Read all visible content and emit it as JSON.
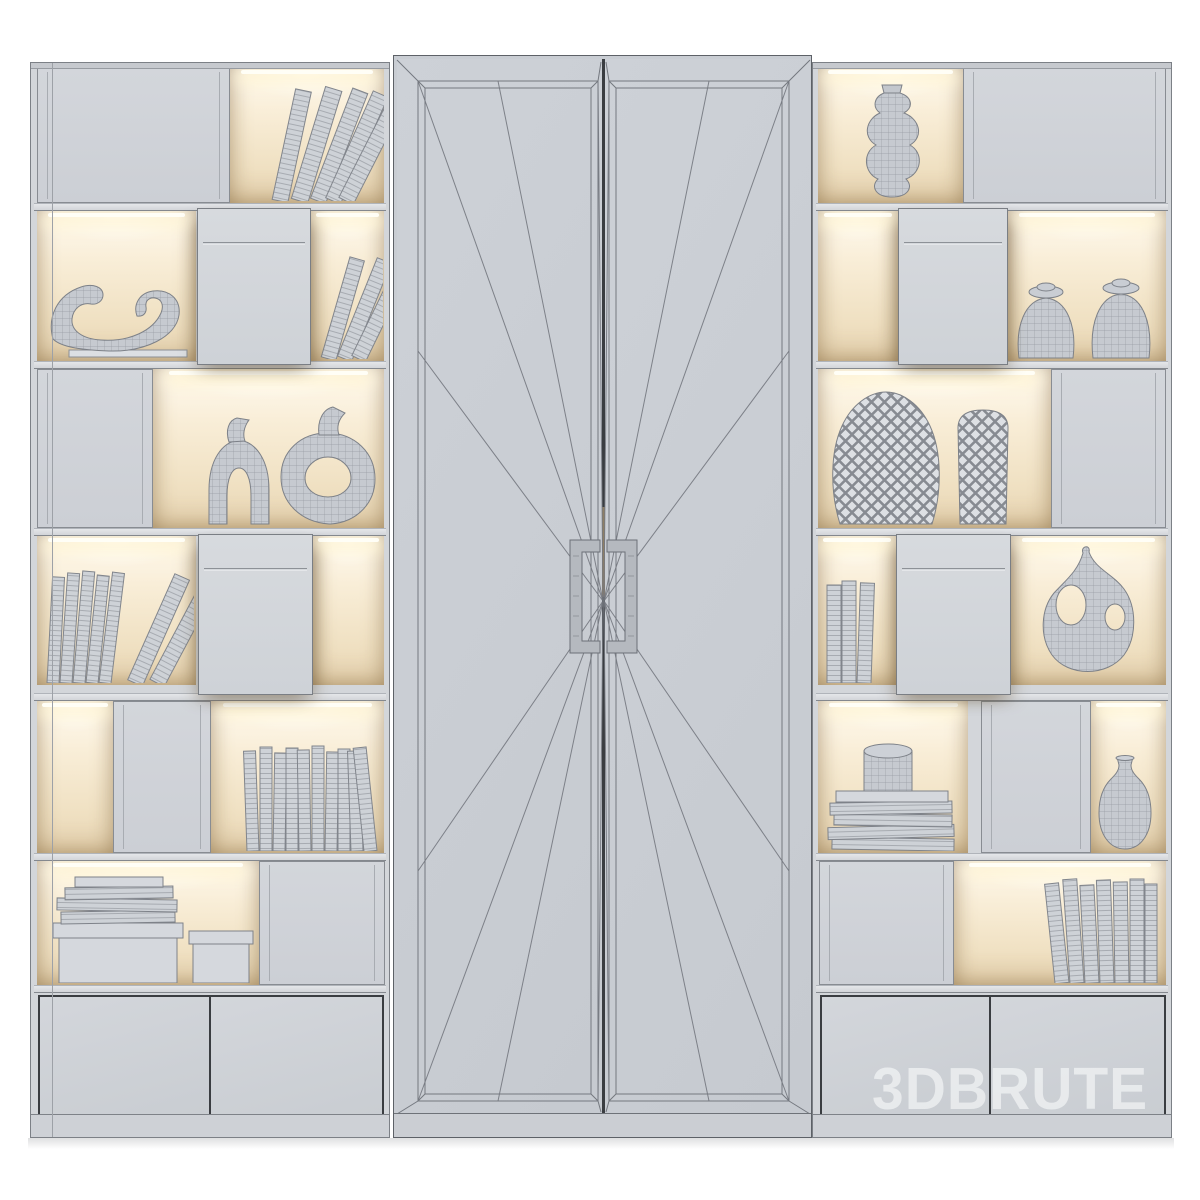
{
  "watermark": {
    "text": "3DBRUTE"
  },
  "palette": {
    "bg": "#ffffff",
    "carcass": "#d3d6da",
    "door-face": "#cfd3d8",
    "center-door": "#c9cdd3",
    "edge": "#7c8086",
    "edge-dark": "#3a3d41",
    "wire": "#74787f",
    "glow-hi": "#fffaf0",
    "glow-mid": "#f5e8cd",
    "glow-low": "#e8d5b2",
    "object-fill": "#c6cad0",
    "object-line": "#878b92",
    "watermark": "rgba(250,251,252,0.6)"
  },
  "scene": {
    "type": "3d-render",
    "style": "wireframe-clay monochrome",
    "subject": "modular wall unit: two display bookcases with lighted niches flanking a tall two-door cabinet",
    "left_bookcase": {
      "rows": [
        [
          "cabinet-door",
          "leaning-books"
        ],
        [
          "lighted-niche-horn-sculpture",
          "drawer-box",
          "leaning-books"
        ],
        [
          "cabinet-door",
          "arch-ring-vase",
          "donut-ring-vase"
        ],
        [
          "leaning-book-stack",
          "drawer-box",
          "lighted-niche-empty"
        ],
        [
          "lighted-niche-empty",
          "cabinet-door",
          "book-row"
        ],
        [
          "book-stack-on-boxes",
          "cabinet-door"
        ]
      ],
      "drawers": 2
    },
    "center_cabinet": {
      "doors": 2,
      "handle_style": "square-bracket pull pair",
      "decor": "sunburst wireframe triangulation lines radiating from handles",
      "frame": "double beveled panel frame"
    },
    "right_bookcase": {
      "rows": [
        [
          "twisted-vase",
          "cabinet-door"
        ],
        [
          "lighted-niche-empty",
          "drawer-box",
          "two-ginger-jars"
        ],
        [
          "diamond-pattern-vases",
          "cabinet-door"
        ],
        [
          "book-trio",
          "drawer-box",
          "organic-pierced-vase"
        ],
        [
          "book-stack-with-cylinder-jar",
          "cabinet-door",
          "bottle-vase"
        ],
        [
          "cabinet-door",
          "book-row"
        ]
      ],
      "drawers": 2
    }
  }
}
